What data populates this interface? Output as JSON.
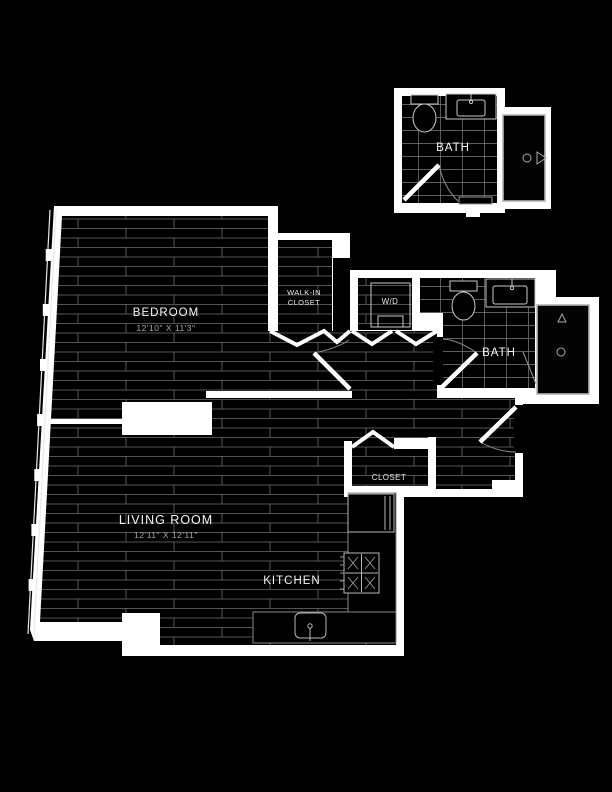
{
  "plan": {
    "colors": {
      "background": "#000000",
      "wall": "#ffffff",
      "floor": "#000000",
      "floor_line": "#7a7a7a",
      "fixture_line": "#b5b5b5",
      "text": "#f5f5f5",
      "dim_text": "#a8a8a8"
    },
    "rooms": {
      "upper_bath": {
        "label": "BATH"
      },
      "bedroom": {
        "label": "BEDROOM",
        "dimensions": "12'10\" X 11'3\""
      },
      "walk_in_closet": {
        "label_line1": "WALK-IN",
        "label_line2": "CLOSET"
      },
      "washer_dryer": {
        "label": "W/D"
      },
      "bath": {
        "label": "BATH"
      },
      "closet": {
        "label": "CLOSET"
      },
      "living_room": {
        "label": "LIVING ROOM",
        "dimensions": "12'11\" X 12'11\""
      },
      "kitchen": {
        "label": "KITCHEN"
      }
    }
  }
}
